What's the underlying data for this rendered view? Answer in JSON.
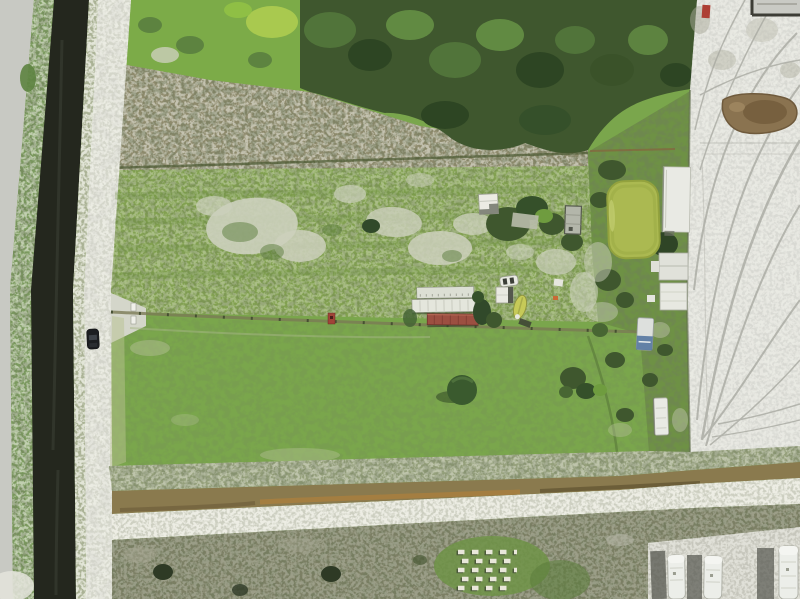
{
  "scene": {
    "type": "aerial-drone-photo",
    "description": "Aerial drone photograph of a rural homestead: a dark drainage canal and dirt roads on the left with a single car, two mowed green pastures divided by a fence line, storage trailers and sheds in the center, a green farm pond and white barn on the right, a white sand lot covered in tire tracks on the far right, a tree line across the top, and a drainage ditch, beehive boxes and three parked RVs along the bottom",
    "palette": {
      "asphalt": "#c8c9c3",
      "shoulder": "#7b9a5e",
      "canal": "#24271e",
      "bank": "#aab295",
      "farm_road": "#d4d6ca",
      "field_upper": "#82a150",
      "field_lower": "#7aa64c",
      "bare_patch": "#ccd0bc",
      "shrubs_bright": "#7cab48",
      "trees_dark": "#3f572e",
      "scrub": "#8e8a6c",
      "veg_strip": "#6e9145",
      "pond": "#abb951",
      "sand": "#dbdcd6",
      "tire_track": "#a9aaa2",
      "puddle": "#8a7350",
      "ditch": "#8a7a4e",
      "gravel": "#cdcfc1",
      "bottom_scrub": "#7c7f64",
      "rv_pad": "#c6c6bc",
      "white_roof": "#e9eae4",
      "red_roof": "#9c4f41",
      "boat": "#c6ca58",
      "car": "#1c1e21",
      "blue_trailer": "#5577a0",
      "shed_gray": "#b3b6aa"
    },
    "objects": [
      {
        "name": "drainage-canal",
        "label": "dark water drainage canal"
      },
      {
        "name": "asphalt-road",
        "label": "paved road edge"
      },
      {
        "name": "farm-road",
        "label": "white gravel farm road"
      },
      {
        "name": "car",
        "label": "dark car on gravel road"
      },
      {
        "name": "gate",
        "label": "white gate posts at driveway"
      },
      {
        "name": "upper-pasture",
        "label": "upper pasture with bare sandy patches"
      },
      {
        "name": "lower-pasture",
        "label": "lower mowed pasture"
      },
      {
        "name": "storage-trailers",
        "label": "two white storage trailers and one red-roofed trailer"
      },
      {
        "name": "white-shed",
        "label": "small white shed"
      },
      {
        "name": "gray-shed",
        "label": "small gray shed"
      },
      {
        "name": "canoe",
        "label": "yellow-green canoe"
      },
      {
        "name": "farm-pond",
        "label": "algae-green farm pond"
      },
      {
        "name": "white-barn",
        "label": "long white-roofed barn"
      },
      {
        "name": "camper-trailers",
        "label": "white camper trailers"
      },
      {
        "name": "sand-lot",
        "label": "white sand lot with tire tracks"
      },
      {
        "name": "mud-puddle",
        "label": "brown mud puddle"
      },
      {
        "name": "tree-line",
        "label": "dense tree line"
      },
      {
        "name": "drainage-ditch",
        "label": "brown drainage ditch and gravel strip"
      },
      {
        "name": "beehives",
        "label": "grid of white beehive boxes"
      },
      {
        "name": "parked-rvs",
        "label": "three white RVs parked on gravel pad"
      }
    ]
  }
}
